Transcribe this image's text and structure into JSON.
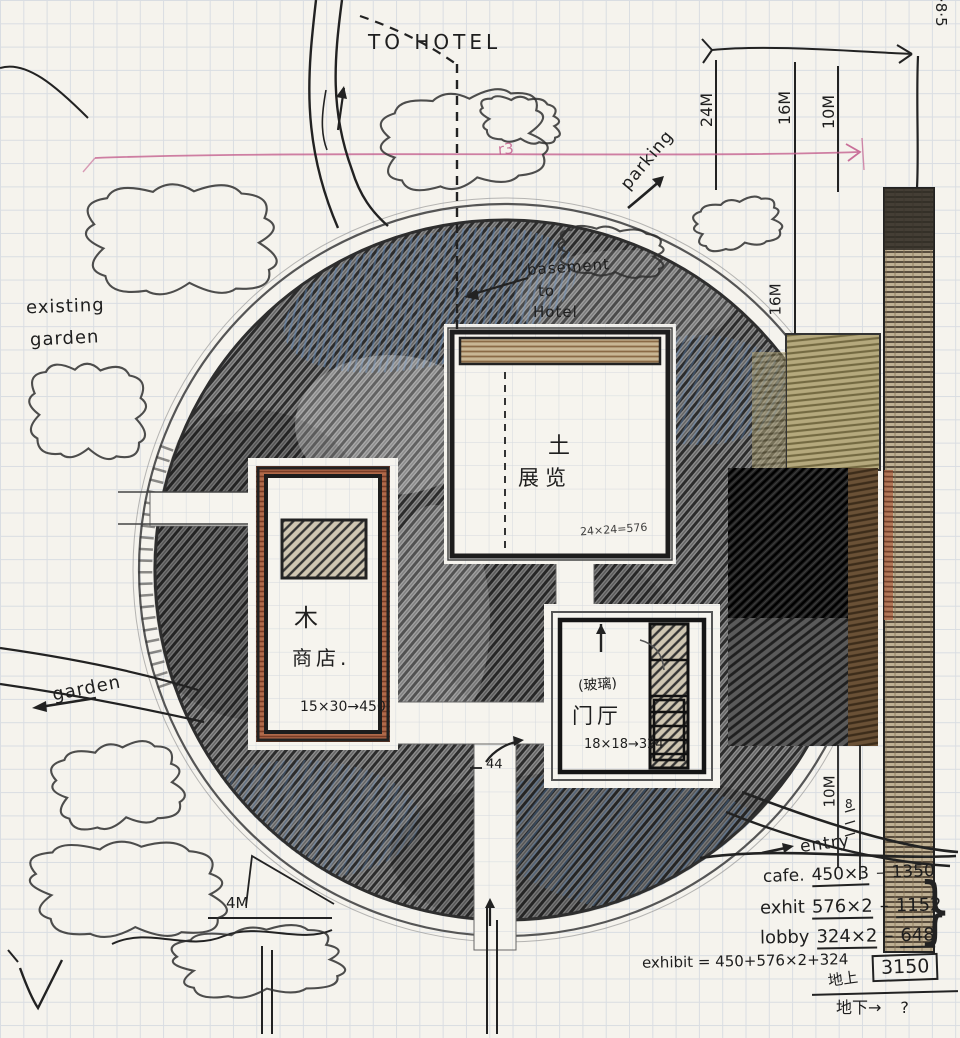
{
  "page": {
    "type": "hand-drawn architectural site plan sketch on graph paper"
  },
  "annotations": {
    "to_hotel": "TO HOTEL",
    "date": "·8·5",
    "parking": "parking",
    "basement_l1": "basement",
    "basement_l2": "to",
    "basement_l3": "Hotel",
    "existing_l1": "existing",
    "existing_l2": "garden",
    "garden": "garden",
    "entry": "entry",
    "r3": "r3",
    "corridor_dim": "44",
    "small_mark": "8"
  },
  "dimensions": {
    "d24": "24M",
    "d16_top": "16M",
    "d10_top": "10M",
    "d16_mid": "16M",
    "d10_right": "10M",
    "d4": "4M"
  },
  "buildings": {
    "exhibition": {
      "material": "土",
      "name": "展览",
      "area": "24×24=576"
    },
    "shop": {
      "material": "木",
      "name": "商店.",
      "area": "15×30→450"
    },
    "lobby": {
      "material": "(玻璃)",
      "name": "门厅",
      "area": "18×18→324"
    }
  },
  "calc": {
    "dash": "–",
    "cafe_label": "cafe.",
    "cafe_expr": "450×3",
    "cafe_result": "1350",
    "exhibit_label": "exhit",
    "exhibit_expr": "576×2",
    "exhibit_result": "1152",
    "lobby_label": "lobby",
    "lobby_expr": "324×2",
    "lobby_result": "648",
    "brace": "}",
    "total_expr": "exhibit = 450+576×2+324",
    "above_ground_label": "地上",
    "total": "3150",
    "below_ground_label": "地下→",
    "below_ground_value": "?"
  },
  "colors": {
    "pencil_dark": "#2c2c2c",
    "blue_tint": "#5f87b8",
    "tan": "#b5a97d",
    "brick": "#b06a4a",
    "pink_line": "#c4608f"
  }
}
